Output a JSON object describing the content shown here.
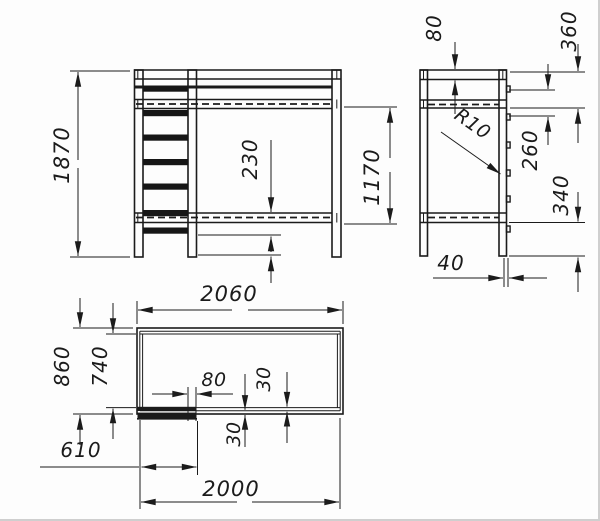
{
  "drawing": {
    "kind": "technical three-view drawing",
    "subject": "loft bunk bed with ladder",
    "unit": "mm",
    "ink_color": "#1b1b1b",
    "paper_color": "#fdfdfd"
  },
  "views": {
    "front": {
      "name": "front view",
      "dims": {
        "total_height": "1870",
        "rung_to_platform": "230",
        "platform_to_base": "1170"
      }
    },
    "side": {
      "name": "side view",
      "dims": {
        "top_rail_height": "80",
        "top_section": "360",
        "rung_pitch": "260",
        "underbed_clearance": "340",
        "rung_radius": "R10",
        "leg_depth": "40"
      }
    },
    "top": {
      "name": "plan view",
      "dims": {
        "overall_length": "2060",
        "overall_width": "860",
        "inner_width": "740",
        "stile_width": "80",
        "board_thickness_inner": "30",
        "board_thickness_outer": "30",
        "ladder_offset": "610",
        "inner_length": "2000"
      }
    }
  }
}
